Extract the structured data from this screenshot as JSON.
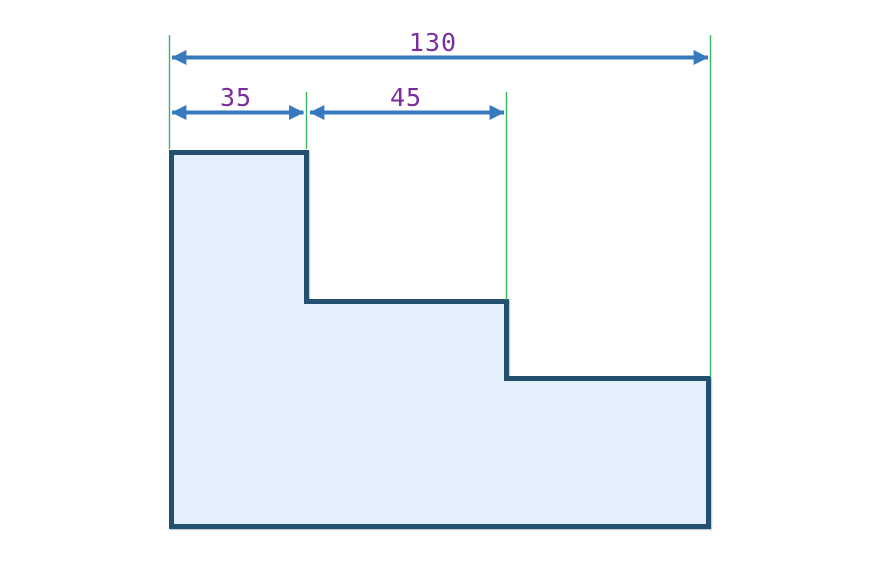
{
  "diagram": {
    "dimension_labels": {
      "total": "130",
      "segment_a": "35",
      "segment_b": "45"
    },
    "dimension_values": {
      "total": 130,
      "segment_a": 35,
      "segment_b": 45
    },
    "colors": {
      "background": "#ffffff",
      "dimension_arrow": "#3779BE",
      "extension_line": "#3CB35F",
      "dimension_text": "#7B2F9F",
      "shape_stroke": "#234F70",
      "shape_fill": "#E3F0FB"
    }
  }
}
